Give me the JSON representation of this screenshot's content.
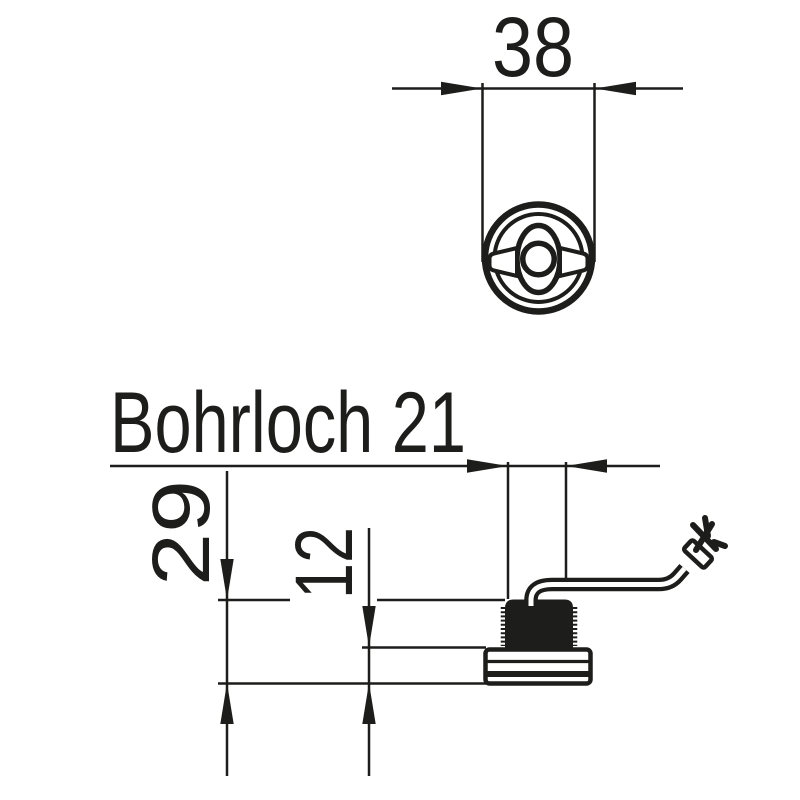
{
  "colors": {
    "ink": "#1d1d1b",
    "background": "#ffffff"
  },
  "drawing": {
    "hole_label": "Bohrloch 21",
    "top_view": {
      "width_dim": "38"
    },
    "side_view": {
      "overall_height_dim": "29",
      "body_height_dim": "12"
    }
  }
}
